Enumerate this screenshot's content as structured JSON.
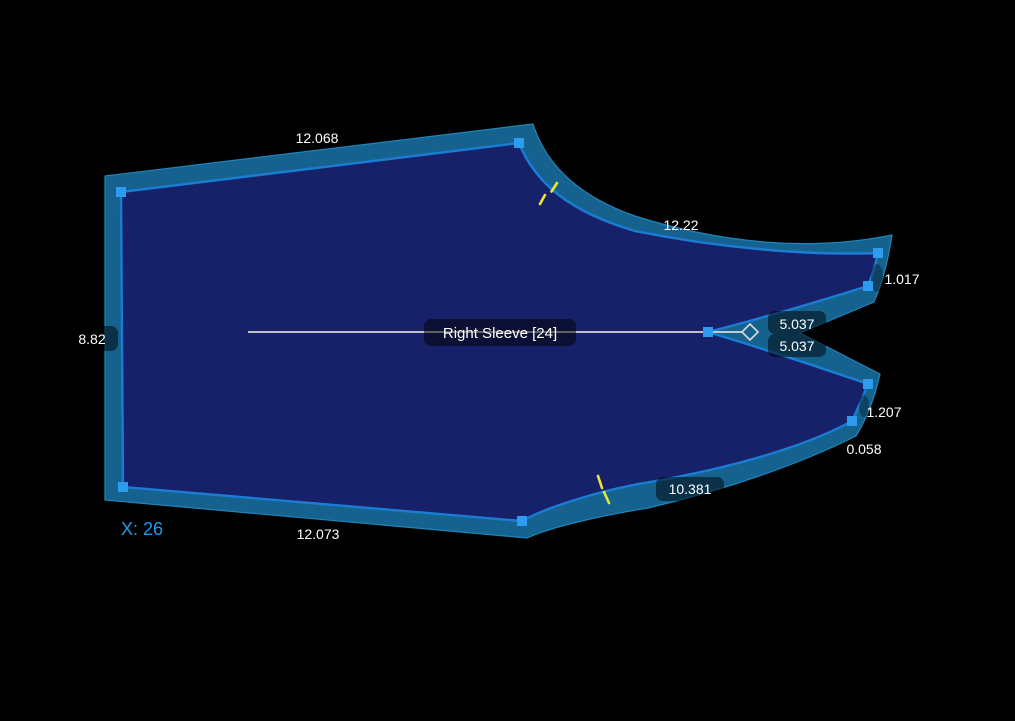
{
  "piece": {
    "label": "Right Sleeve [24]",
    "position_label": "X: 26"
  },
  "measurements": {
    "top_edge": "12.068",
    "cap_curve": "12.22",
    "upper_tip_edge": "1.017",
    "dart_upper": "5.037",
    "dart_lower": "5.037",
    "lower_tip_edge": "1.207",
    "tip_gap": "0.058",
    "underarm_curve": "10.381",
    "bottom_edge": "12.073",
    "left_edge": "8.82"
  },
  "colors": {
    "background": "#000000",
    "band": "#15628E",
    "band_edge": "#1E85B8",
    "piece": "#162169",
    "seam": "#1B7CD4",
    "handle": "#2D9BEE",
    "notch": "#E8E832",
    "guide_line": "#D9D9D9",
    "label_text": "#FFFFFF",
    "coord_text": "#1C9BEA"
  }
}
